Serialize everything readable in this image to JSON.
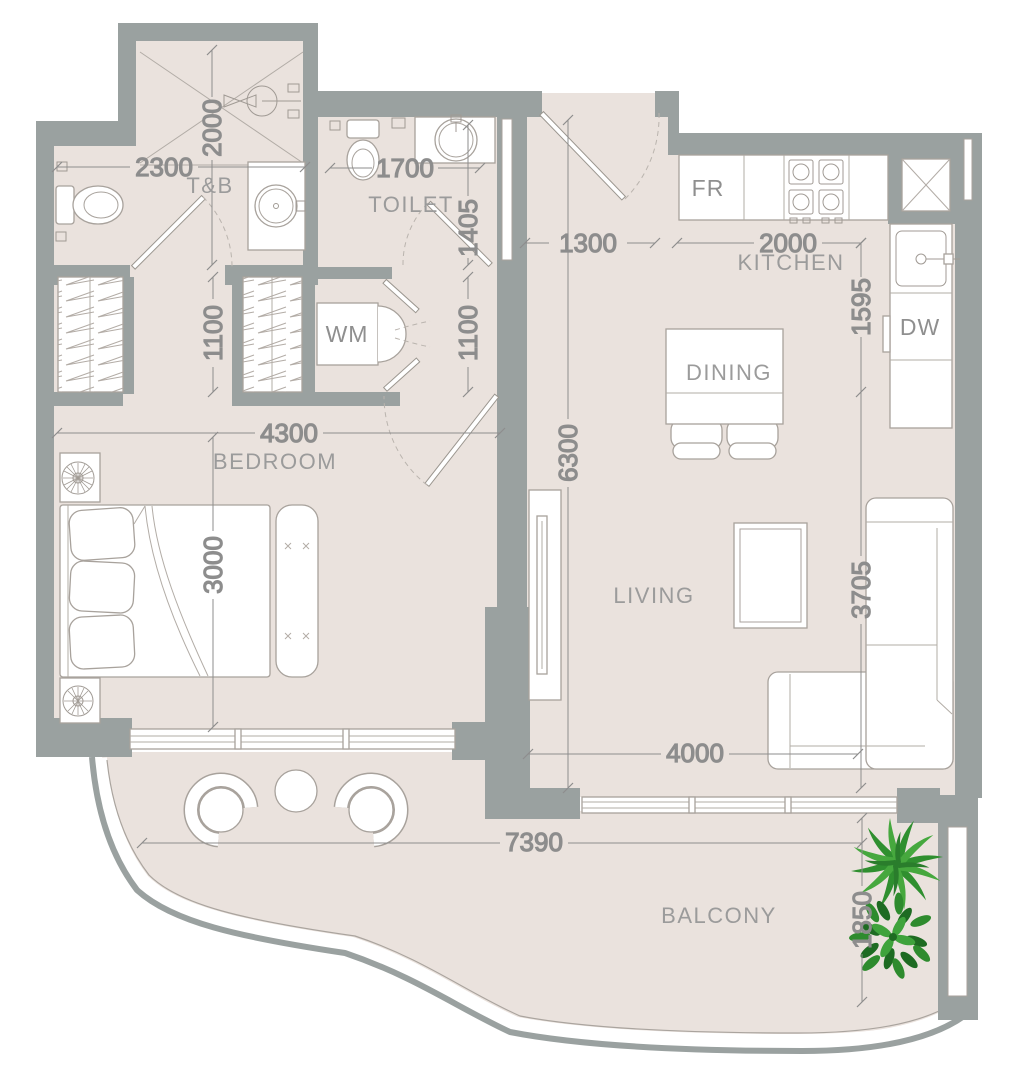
{
  "labels": {
    "rooms": {
      "tb": "T&B",
      "toilet": "TOILET",
      "kitchen": "KITCHEN",
      "dining": "DINING",
      "living": "LIVING",
      "bedroom": "BEDROOM",
      "balcony": "BALCONY"
    },
    "appliances": {
      "washing_machine": "WM",
      "fridge": "FR",
      "dishwasher": "DW"
    }
  },
  "dimensions_mm": {
    "tb_width": "2300",
    "tb_depth": "2000",
    "toilet_width": "1700",
    "toilet_depth": "1405",
    "wardrobe_depth": "1100",
    "hall_depth": "1100",
    "bedroom_width": "4300",
    "bedroom_depth": "3000",
    "entry_width": "1300",
    "kitchen_width": "2000",
    "kitchen_depth": "1595",
    "living_length": "6300",
    "living_width": "3705",
    "living_window": "4000",
    "balcony_width": "7390",
    "balcony_depth": "1850"
  },
  "colors": {
    "wall": "#9aa1a0",
    "floor": "#eae2dd",
    "outline": "#a8a29c",
    "dim_text": "#8d8d8d",
    "room_text": "#9b9b9b",
    "plant_green": "#2e8b2e"
  }
}
